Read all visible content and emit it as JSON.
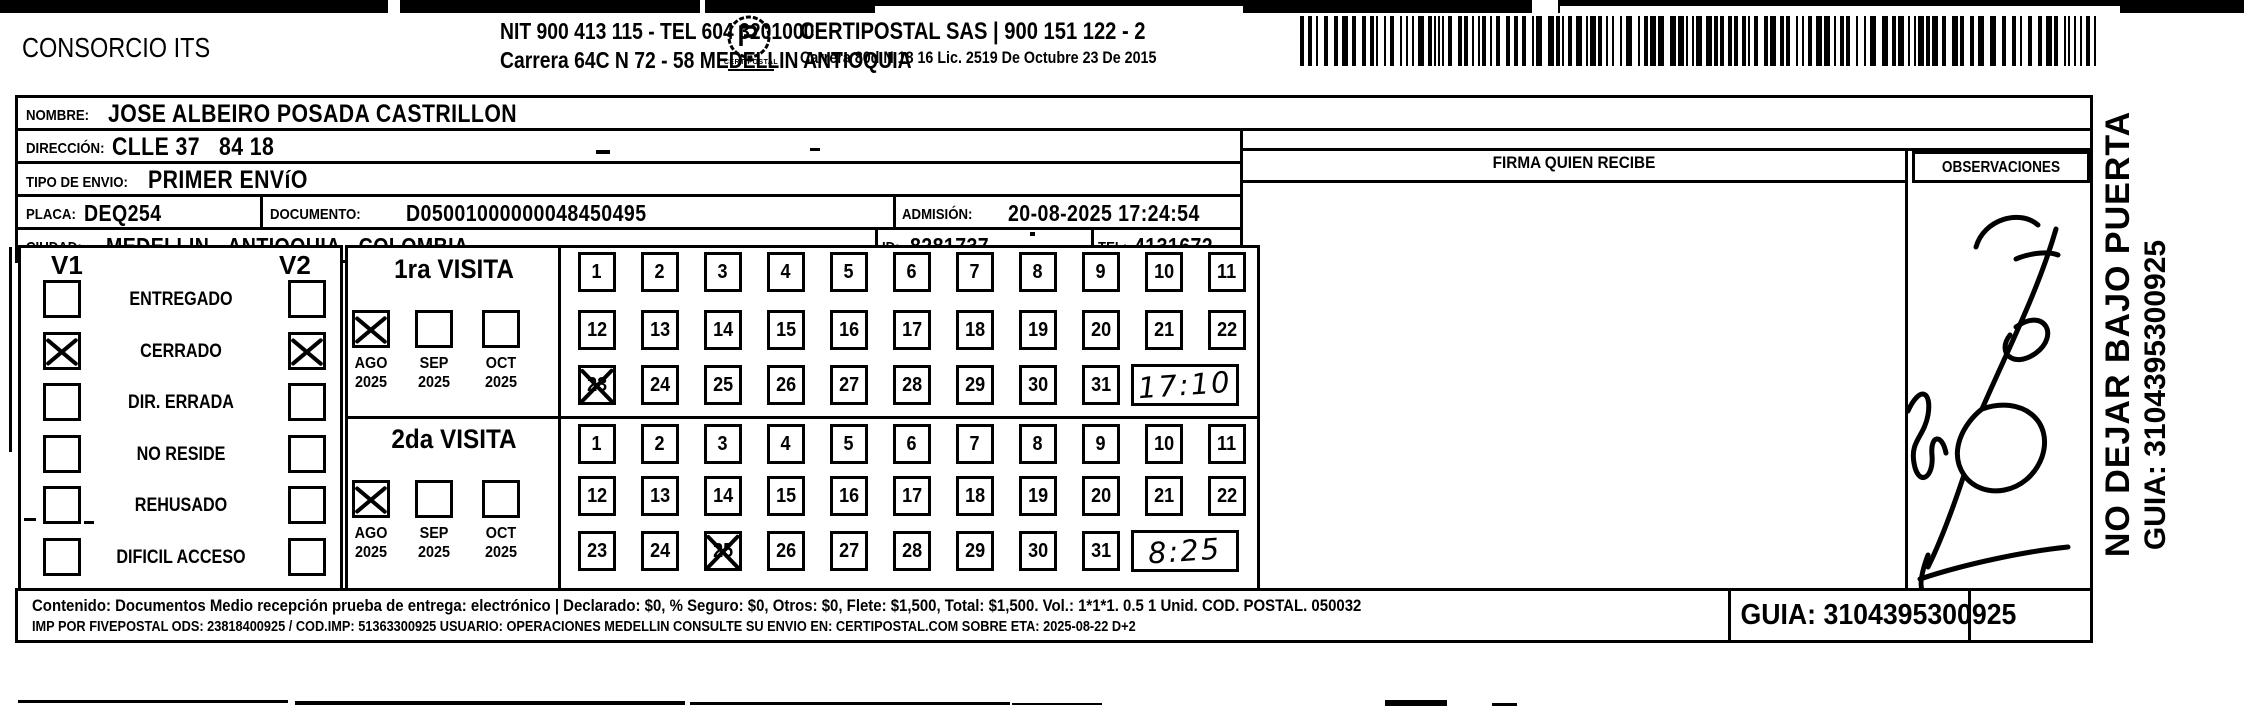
{
  "header": {
    "company": "CONSORCIO ITS",
    "nit_line": "NIT 900 413 115 - TEL 604 3201000",
    "company_address": "Carrera 64C N 72 - 58 MEDELLIN ANTIOQUIA",
    "logo_caption": "CERTIPOSTAL",
    "partner_line": "CERTIPOSTAL SAS | 900 151 122 - 2",
    "partner_address": "Carrera 80d N 18 16  Lic. 2519 De Octubre 23 De 2015"
  },
  "fields": {
    "nombre_label": "NOMBRE:",
    "nombre": "JOSE ALBEIRO POSADA CASTRILLON",
    "direccion_label": "DIRECCIÓN:",
    "direccion": "CLLE 37   84 18",
    "tipo_label": "TIPO DE ENVIO:",
    "tipo": "PRIMER ENVíO",
    "placa_label": "PLACA:",
    "placa": "DEQ254",
    "documento_label": "DOCUMENTO:",
    "documento": "D05001000000048450495",
    "admision_label": "ADMISIÓN:",
    "admision": "20-08-2025 17:24:54",
    "ciudad_label": "CIUDAD:",
    "ciudad": "MEDELLIN - ANTIOQUIA - COLOMBIA",
    "id_label": "ID:",
    "id_value": "8281737",
    "tel_label": "TEL:",
    "tel": "4131672"
  },
  "columns": {
    "firma": "FIRMA QUIEN RECIBE",
    "observaciones": "OBSERVACIONES"
  },
  "status": {
    "v1": "V1",
    "v2": "V2",
    "options": [
      {
        "label": "ENTREGADO",
        "v1": false,
        "v2": false
      },
      {
        "label": "CERRADO",
        "v1": true,
        "v2": true
      },
      {
        "label": "DIR. ERRADA",
        "v1": false,
        "v2": false
      },
      {
        "label": "NO RESIDE",
        "v1": false,
        "v2": false
      },
      {
        "label": "REHUSADO",
        "v1": false,
        "v2": false
      },
      {
        "label": "DIFICIL ACCESO",
        "v1": false,
        "v2": false
      }
    ]
  },
  "visits": [
    {
      "title": "1ra VISITA",
      "months": [
        {
          "month": "AGO",
          "year": "2025",
          "checked": true
        },
        {
          "month": "SEP",
          "year": "2025",
          "checked": false
        },
        {
          "month": "OCT",
          "year": "2025",
          "checked": false
        }
      ],
      "day_rows": [
        [
          1,
          2,
          3,
          4,
          5,
          6,
          7,
          8,
          9,
          10,
          11
        ],
        [
          12,
          13,
          14,
          15,
          16,
          17,
          18,
          19,
          20,
          21,
          22
        ],
        [
          23,
          24,
          25,
          26,
          27,
          28,
          29,
          30,
          31
        ]
      ],
      "marked_day": 23,
      "time": "17:10"
    },
    {
      "title": "2da VISITA",
      "months": [
        {
          "month": "AGO",
          "year": "2025",
          "checked": true
        },
        {
          "month": "SEP",
          "year": "2025",
          "checked": false
        },
        {
          "month": "OCT",
          "year": "2025",
          "checked": false
        }
      ],
      "day_rows": [
        [
          1,
          2,
          3,
          4,
          5,
          6,
          7,
          8,
          9,
          10,
          11
        ],
        [
          12,
          13,
          14,
          15,
          16,
          17,
          18,
          19,
          20,
          21,
          22
        ],
        [
          23,
          24,
          25,
          26,
          27,
          28,
          29,
          30,
          31
        ]
      ],
      "marked_day": 25,
      "time": "8:25"
    }
  ],
  "footer": {
    "line1": "Contenido: Documentos Medio recepción prueba de entrega: electrónico | Declarado: $0, % Seguro: $0, Otros: $0, Flete: $1,500, Total: $1,500. Vol.: 1*1*1. 0.5  1 Unid. COD. POSTAL. 050032",
    "line2": "IMP POR FIVEPOSTAL ODS: 23818400925 / COD.IMP: 51363300925 USUARIO: OPERACIONES MEDELLIN CONSULTE SU ENVIO EN: CERTIPOSTAL.COM SOBRE ETA: 2025-08-22 D+2",
    "guia_box": "GUIA: 3104395300925"
  },
  "side_notes": {
    "no_dejar": "NO DEJAR BAJO PUERTA",
    "guia": "GUIA: 3104395300925"
  }
}
